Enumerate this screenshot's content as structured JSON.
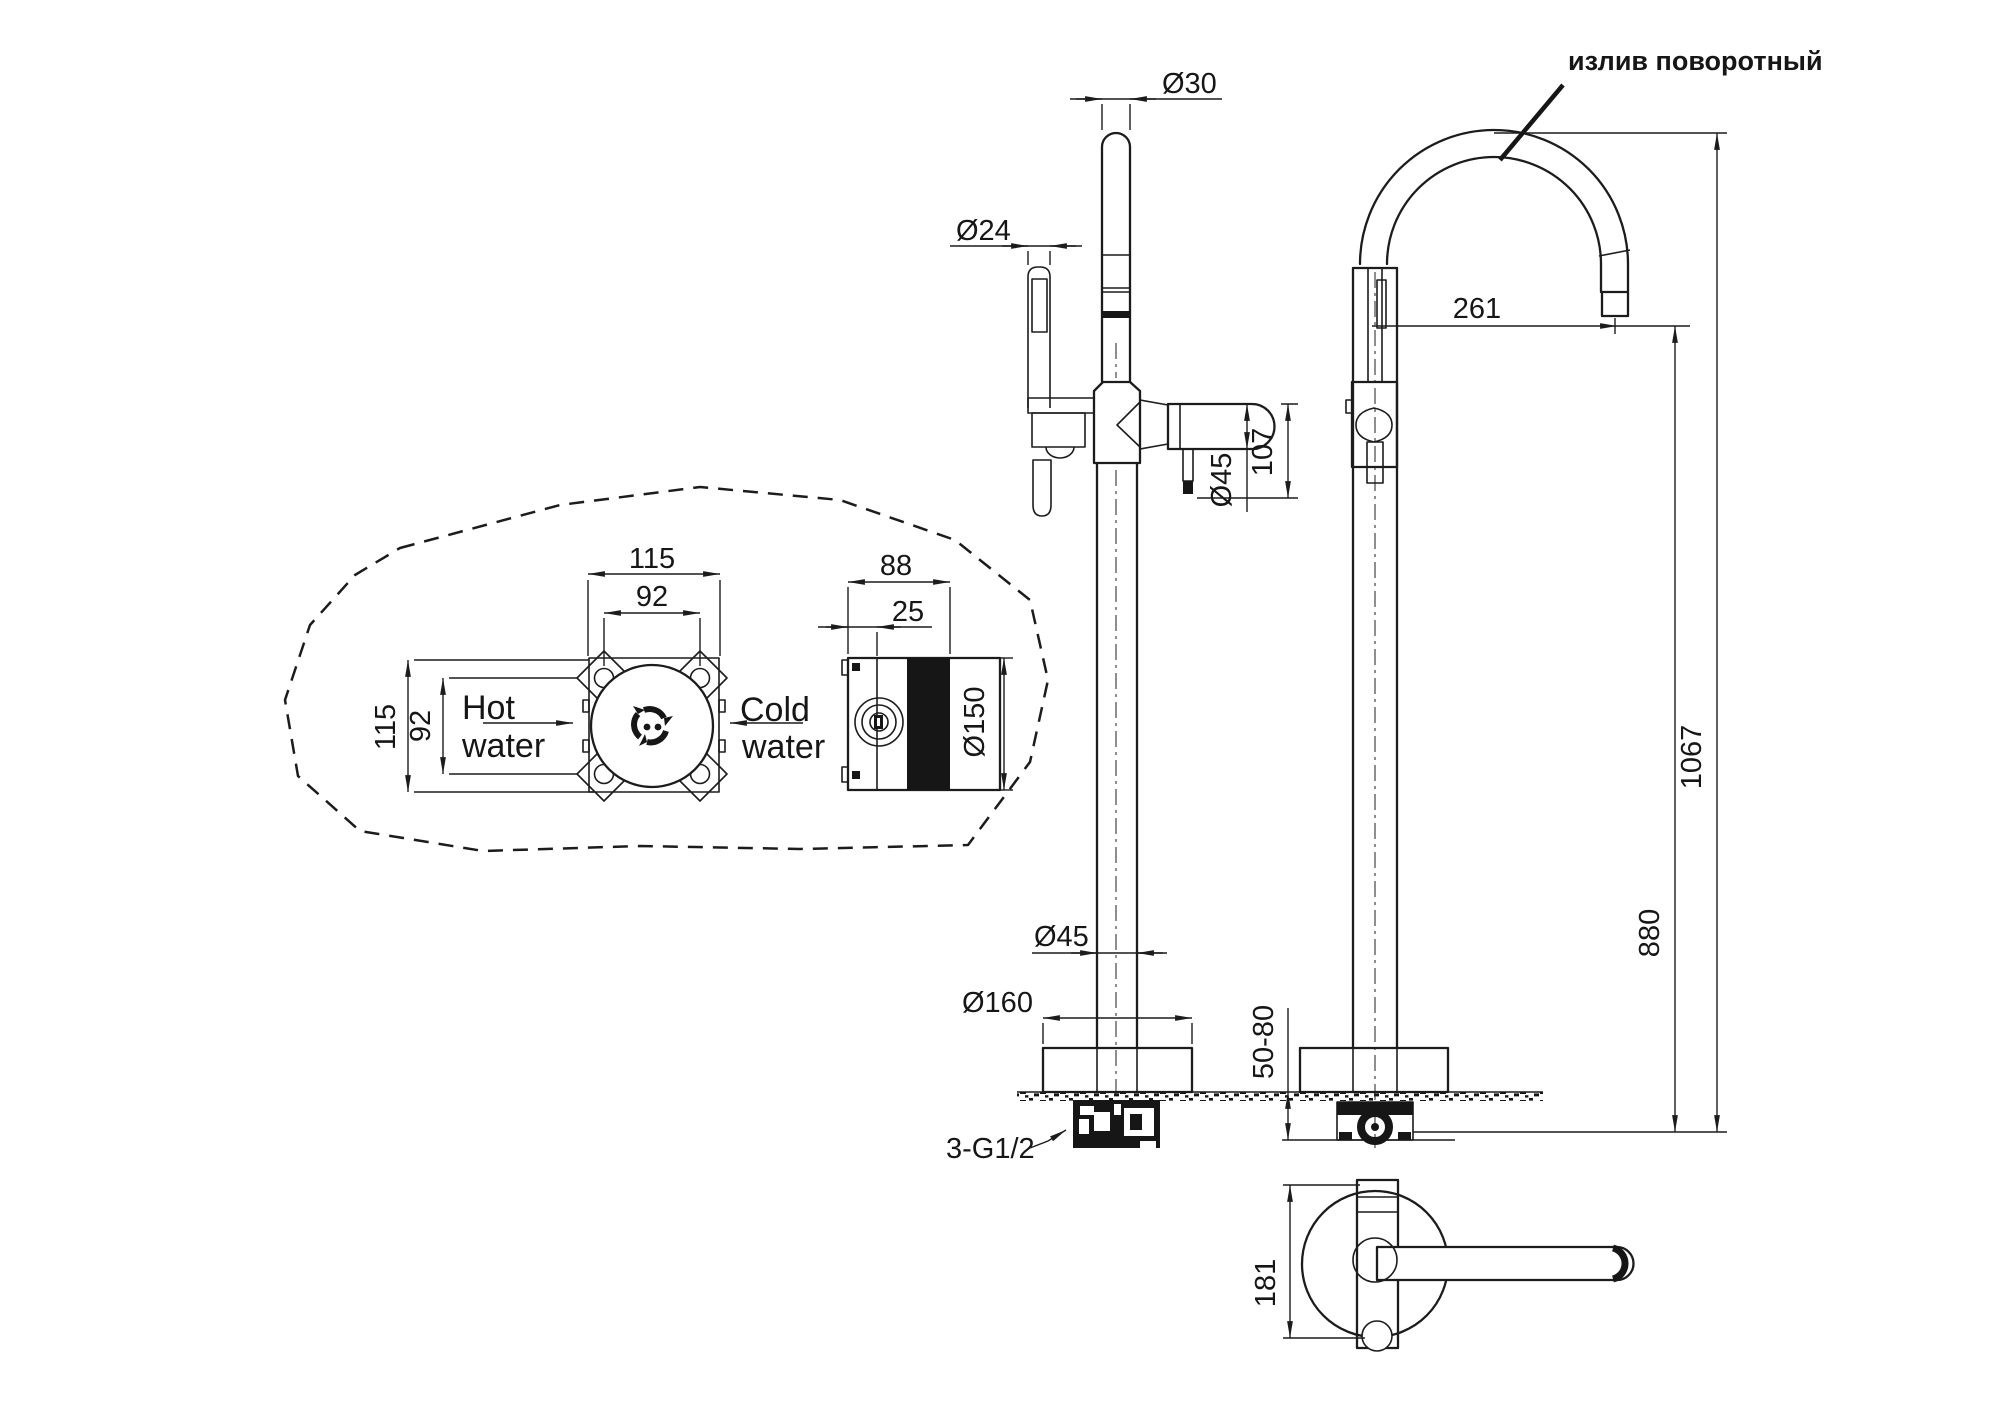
{
  "labels": {
    "spout_note": "излив поворотный",
    "hot_line1": "Hot",
    "hot_line2": "water",
    "cold_line1": "Cold",
    "cold_line2": "water",
    "thread_note": "3-G1/2"
  },
  "dimensions": {
    "riser_diameter": "Ø30",
    "handshower_diameter": "Ø24",
    "spout_reach": "261",
    "valve_height": "107",
    "handle_diameter": "Ø45",
    "pipe_diameter": "Ø45",
    "base_diameter": "Ø160",
    "floor_thickness": "50-80",
    "overall_height": "1067",
    "spout_height": "880",
    "plan_width": "181",
    "box_width": "115",
    "box_hole_spacing_w": "92",
    "box_height": "115",
    "box_hole_spacing_h": "92",
    "box_depth": "88",
    "box_flange_offset": "25",
    "box_diameter": "Ø150"
  },
  "colors": {
    "line": "#1c1c1c",
    "background": "#ffffff"
  }
}
